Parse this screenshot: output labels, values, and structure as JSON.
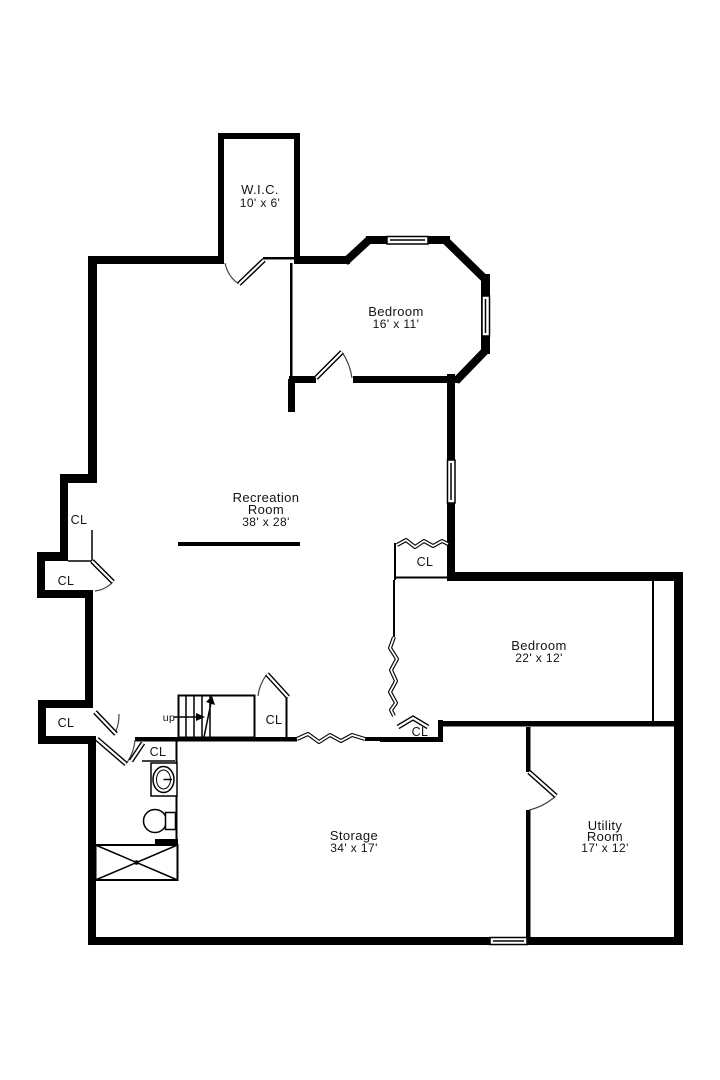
{
  "floor_plan": {
    "colors": {
      "wall": "#000000",
      "background": "#ffffff",
      "text": "#141414"
    },
    "rooms": {
      "wic": {
        "name": "W.I.C.",
        "dims": "10' x 6'"
      },
      "bedroom_top": {
        "name": "Bedroom",
        "dims": "16' x 11'"
      },
      "recreation": {
        "name_line1": "Recreation",
        "name_line2": "Room",
        "dims": "38' x 28'"
      },
      "bedroom_right": {
        "name": "Bedroom",
        "dims": "22' x 12'"
      },
      "storage": {
        "name": "Storage",
        "dims": "34' x 17'"
      },
      "utility": {
        "name_line1": "Utility",
        "name_line2": "Room",
        "dims": "17' x 12'"
      }
    },
    "labels": {
      "closet": "CL",
      "stairs_direction": "up"
    }
  }
}
